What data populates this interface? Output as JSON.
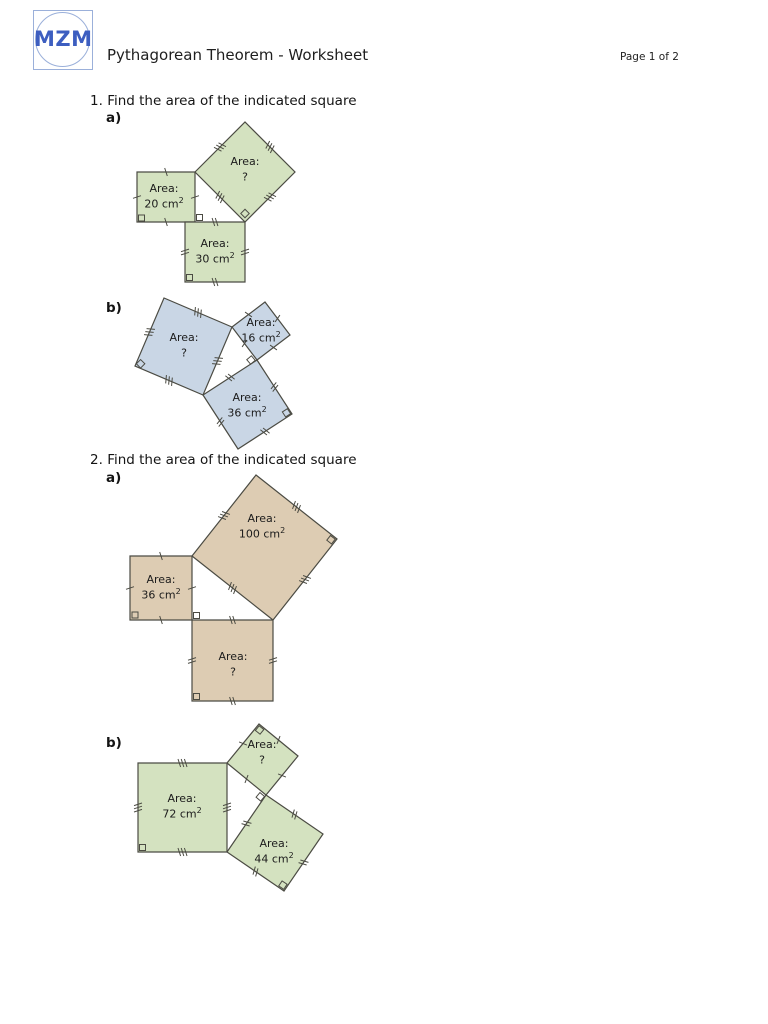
{
  "header": {
    "logo_text": "MZM",
    "title": "Pythagorean Theorem - Worksheet",
    "page_label": "Page 1 of 2"
  },
  "colors": {
    "green": "#d4e2c0",
    "blue": "#c9d6e5",
    "tan": "#ddccb3",
    "stroke": "#4b4b43",
    "logo_blue": "#3d5ec0"
  },
  "questions": [
    {
      "number": "1.",
      "prompt": "Find the area of the indicated square",
      "parts": [
        {
          "label": "a)",
          "squares": [
            {
              "label": "Area:",
              "value": "?",
              "sup": ""
            },
            {
              "label": "Area:",
              "value": "20 cm",
              "sup": "2"
            },
            {
              "label": "Area:",
              "value": "30 cm",
              "sup": "2"
            }
          ]
        },
        {
          "label": "b)",
          "squares": [
            {
              "label": "Area:",
              "value": "?",
              "sup": ""
            },
            {
              "label": "Area:",
              "value": "16 cm",
              "sup": "2"
            },
            {
              "label": "Area:",
              "value": "36 cm",
              "sup": "2"
            }
          ]
        }
      ]
    },
    {
      "number": "2.",
      "prompt": "Find the area of the indicated square",
      "parts": [
        {
          "label": "a)",
          "squares": [
            {
              "label": "Area:",
              "value": "100 cm",
              "sup": "2"
            },
            {
              "label": "Area:",
              "value": "36 cm",
              "sup": "2"
            },
            {
              "label": "Area:",
              "value": "?",
              "sup": ""
            }
          ]
        },
        {
          "label": "b)",
          "squares": [
            {
              "label": "Area:",
              "value": "72 cm",
              "sup": "2"
            },
            {
              "label": "Area:",
              "value": "?",
              "sup": ""
            },
            {
              "label": "Area:",
              "value": "44 cm",
              "sup": "2"
            }
          ]
        }
      ]
    }
  ]
}
